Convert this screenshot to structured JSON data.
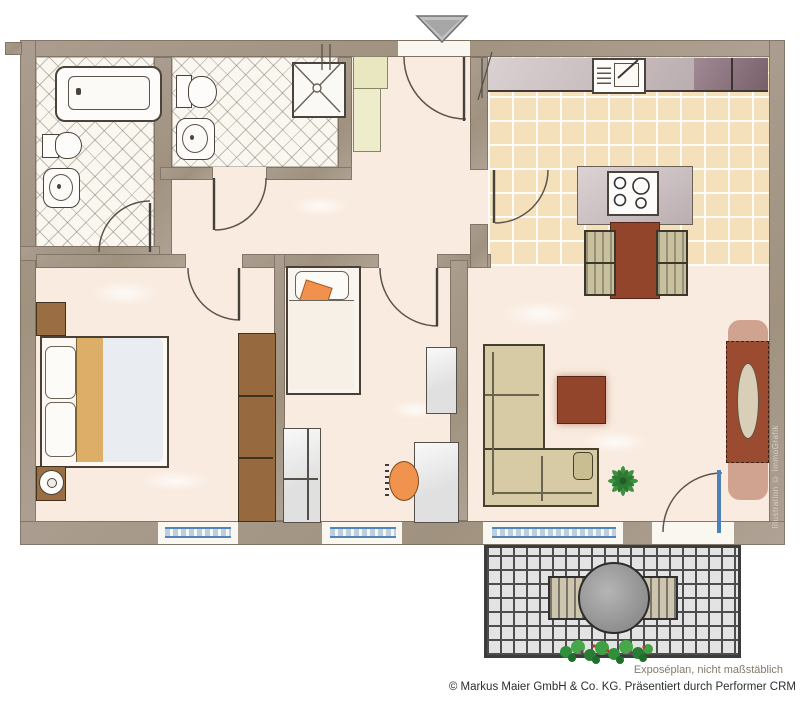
{
  "footer": {
    "disclaimer": "Exposéplan, nicht maßstäblich",
    "copyright": "© Markus Maier GmbH & Co. KG. Präsentiert durch Performer CRM"
  },
  "watermark": "Illustration © ImmoGrafik",
  "colors": {
    "wall": "#a5988a",
    "floor": "#f9ebdf",
    "bath_tile_line": "#887e6e",
    "kitchen_floor": "#f4e0ba",
    "counter": "#c6b8bb",
    "cabinet_dark": "#8c707d",
    "wood_red": "#93452c",
    "wood_brown": "#9a6e42",
    "bed_tan": "#dcae67",
    "sofa_upholstery": "#d6cba4",
    "chair_beige": "#c9c09e",
    "accent_orange": "#f0934e",
    "plant_green": "#3d9141",
    "window_blue": "#4f84bc",
    "balcony_tile": "#e3e3e3",
    "entrance_marker": "#c2c2c2"
  }
}
